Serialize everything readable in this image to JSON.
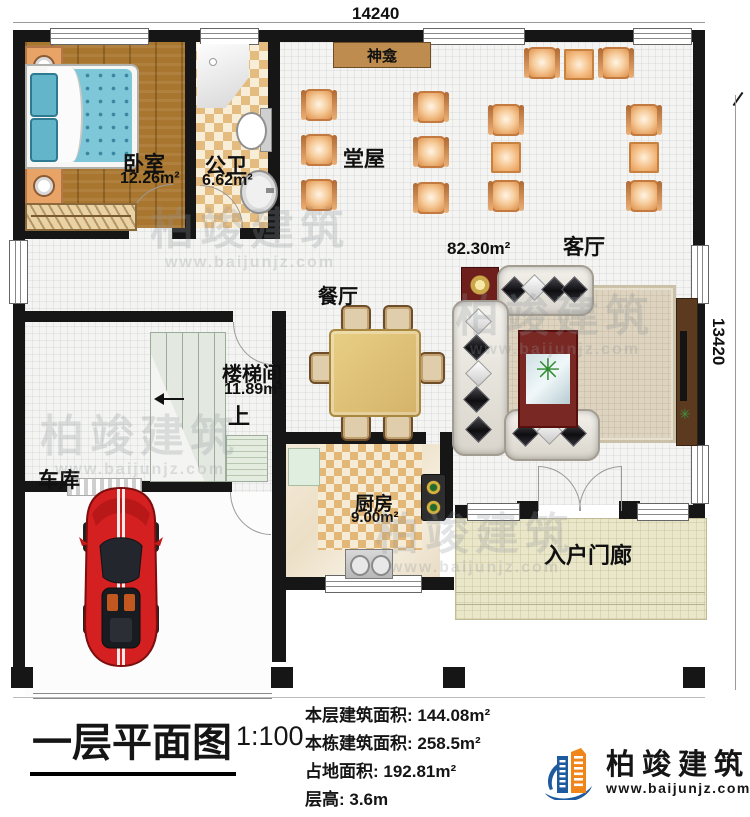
{
  "dimensions": {
    "width_top": "14240",
    "height_right": "13420"
  },
  "rooms": {
    "bedroom": {
      "label": "卧室",
      "area": "12.26m²"
    },
    "bathroom": {
      "label": "公卫",
      "area": "6.62m²"
    },
    "shrine": {
      "label": "神龛"
    },
    "hall": {
      "label": "堂屋"
    },
    "living": {
      "label": "客厅",
      "area": "82.30m²"
    },
    "dining": {
      "label": "餐厅"
    },
    "stair": {
      "label": "楼梯间",
      "area": "11.89m²",
      "up": "上"
    },
    "garage": {
      "label": "车库"
    },
    "kitchen": {
      "label": "厨房",
      "area": "9.00m²"
    },
    "porch": {
      "label": "入户门廊"
    }
  },
  "title_block": {
    "title": "一层平面图",
    "scale": "1:100",
    "stats": [
      "本层建筑面积: 144.08m²",
      "本栋建筑面积: 258.5m²",
      "占地面积: 192.81m²",
      "层高: 3.6m"
    ]
  },
  "logo": {
    "name": "柏竣建筑",
    "website": "www.baijunjz.com"
  },
  "watermark": {
    "text": "柏竣建筑",
    "url": "www.baijunjz.com"
  },
  "colors": {
    "wall": "#161616",
    "chair_orange": "#e5a160",
    "logo_blue": "#1d5a9e",
    "logo_orange": "#f08519",
    "car_red": "#d42020"
  }
}
